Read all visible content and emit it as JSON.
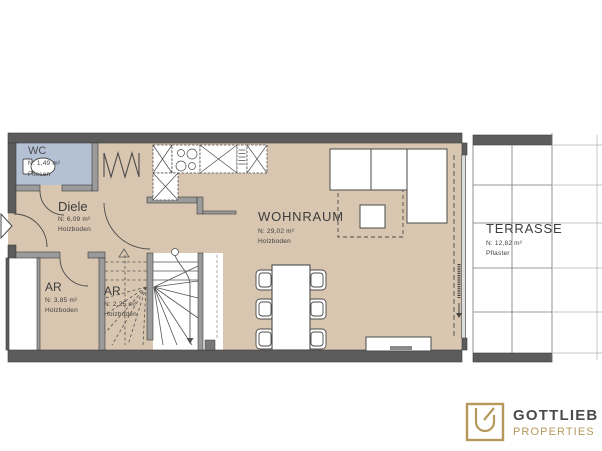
{
  "plan": {
    "rooms": [
      {
        "id": "wc",
        "name": "WC",
        "area": "N: 1,49 m²",
        "floor": "Fliesen"
      },
      {
        "id": "diele",
        "name": "Diele",
        "area": "N: 6,09 m²",
        "floor": "Holzboden"
      },
      {
        "id": "ar-left",
        "name": "AR",
        "area": "N: 3,85 m²",
        "floor": "Holzboden"
      },
      {
        "id": "ar-right",
        "name": "AR",
        "area": "N: 2,25 m²",
        "floor": "Holzboden"
      },
      {
        "id": "wohnraum",
        "name": "WOHNRAUM",
        "area": "N: 29,02 m²",
        "floor": "Holzboden"
      },
      {
        "id": "terrasse",
        "name": "TERRASSE",
        "area": "N: 12,82 m²",
        "floor": "Pflaster"
      }
    ],
    "colors": {
      "wall": "#5c5c5c",
      "floor_wood": "#d8c6b0",
      "floor_tile_wc": "#b4c1d4",
      "terrace_floor": "#ffffff"
    }
  },
  "logo": {
    "brand": "GOTTLIEB",
    "subtitle": "PROPERTIES",
    "gold": "#b5985a",
    "gray": "#4b4b4b"
  }
}
